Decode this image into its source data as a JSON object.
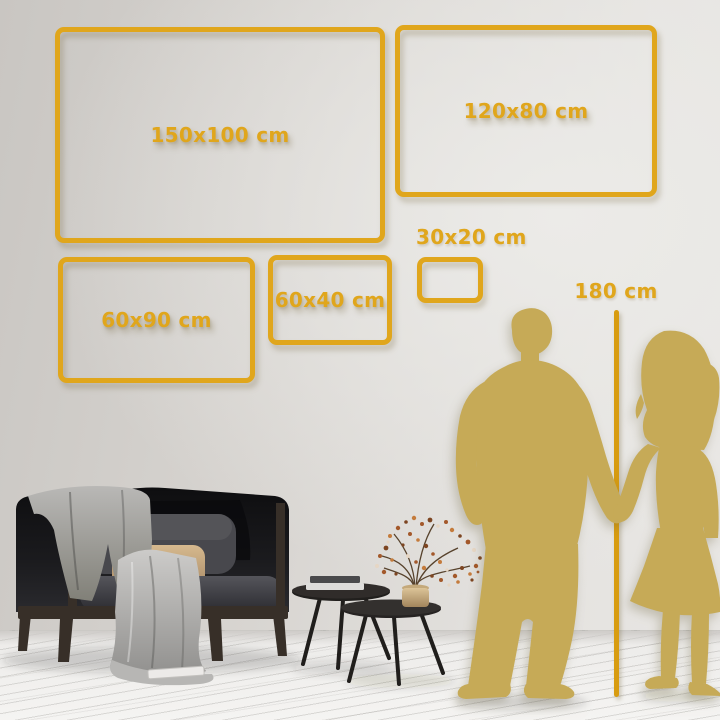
{
  "size_guide": {
    "frames": [
      {
        "label": "150x100 cm"
      },
      {
        "label": "120x80 cm"
      },
      {
        "label": "60x90 cm"
      },
      {
        "label": "60x40 cm"
      },
      {
        "label": "30x20 cm"
      }
    ],
    "height_reference_label": "180 cm"
  },
  "colors": {
    "gold": "#e0a61c",
    "gold-dark": "#d89c10",
    "silhouette": "#c6aa57",
    "sofa-dark": "#141417",
    "blanket-gray": "#a9a8a6",
    "pillow-tan": "#cbaa7e",
    "wood-brown": "#372f28",
    "table-dark": "#262322",
    "vase-brass": "#c9ad7e",
    "blossom-rust": "#a3582a"
  },
  "illustrations": {
    "couple_silhouette": "man and woman holding hands",
    "height_pole": "vertical 180 cm reference line",
    "sofa": "dark loveseat with draped blanket and pillows",
    "coffee_tables": "two round nesting tables with stacked books",
    "vase": "brass vase with dried blossom branch"
  }
}
